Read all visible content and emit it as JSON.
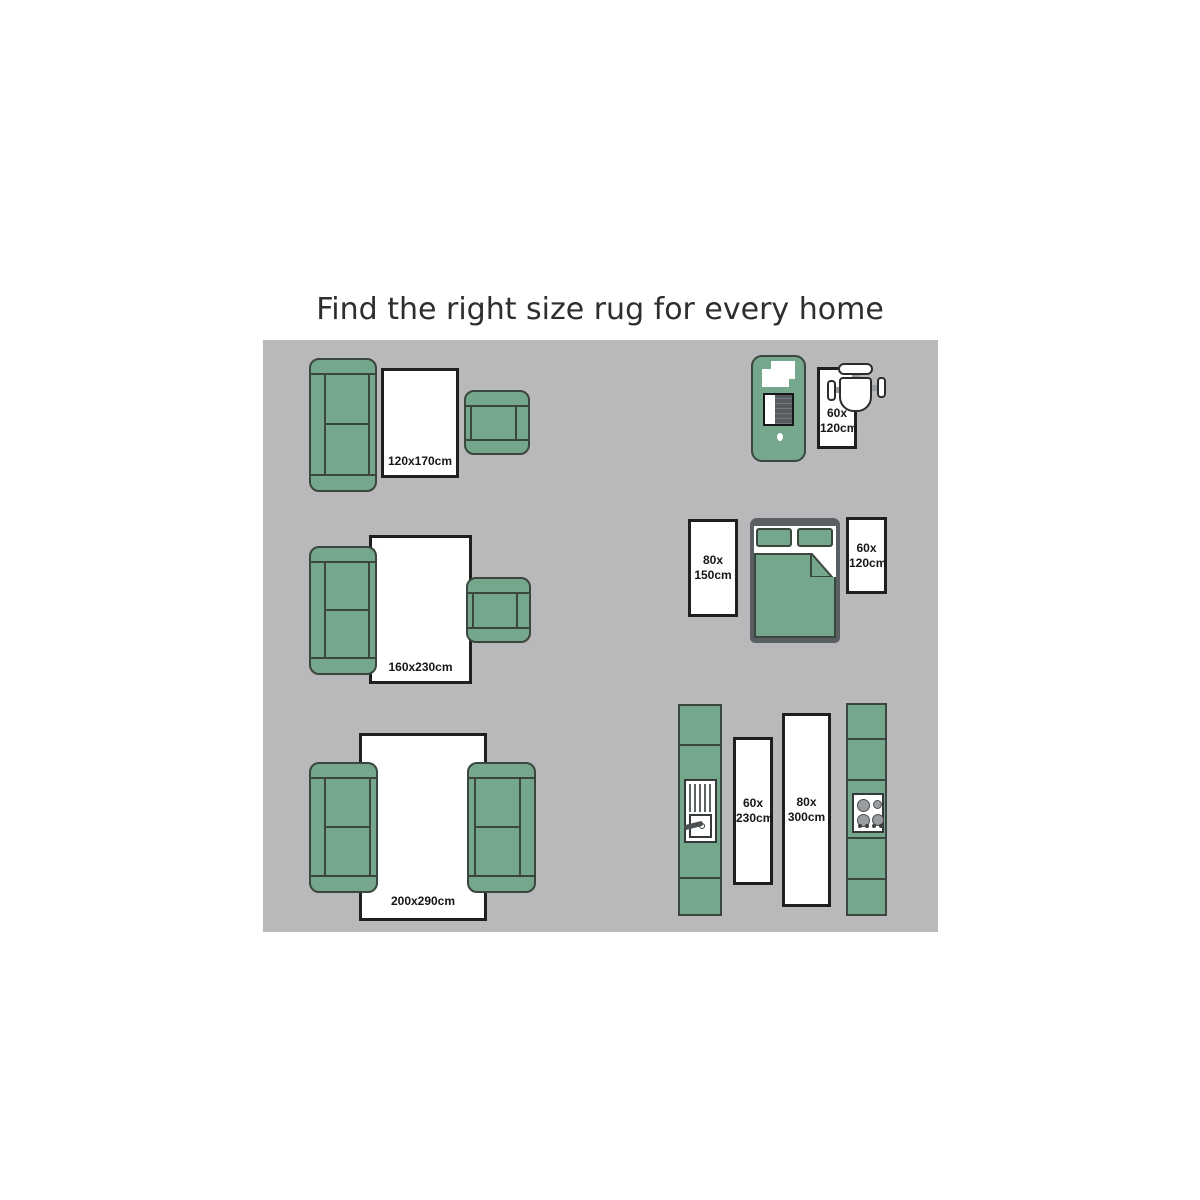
{
  "title": "Find the right size rug for every home",
  "colors": {
    "furniture_green": "#74a78b",
    "outline_dark": "#3a463e",
    "panel_gray": "#b9b9bb",
    "rug_white": "#ffffff",
    "rug_border": "#1f1f1f",
    "bed_frame_gray": "#5a5f64",
    "label_text": "#161616"
  },
  "rooms": {
    "living_small": {
      "rug_label": "120x170cm"
    },
    "living_medium": {
      "rug_label": "160x230cm"
    },
    "living_large": {
      "rug_label": "200x290cm"
    },
    "office": {
      "rug_label": "60x\n120cm"
    },
    "bedroom": {
      "left_rug_label": "80x\n150cm",
      "right_rug_label": "60x\n120cm"
    },
    "kitchen": {
      "left_rug_label": "60x\n230cm",
      "right_rug_label": "80x\n300cm"
    }
  }
}
